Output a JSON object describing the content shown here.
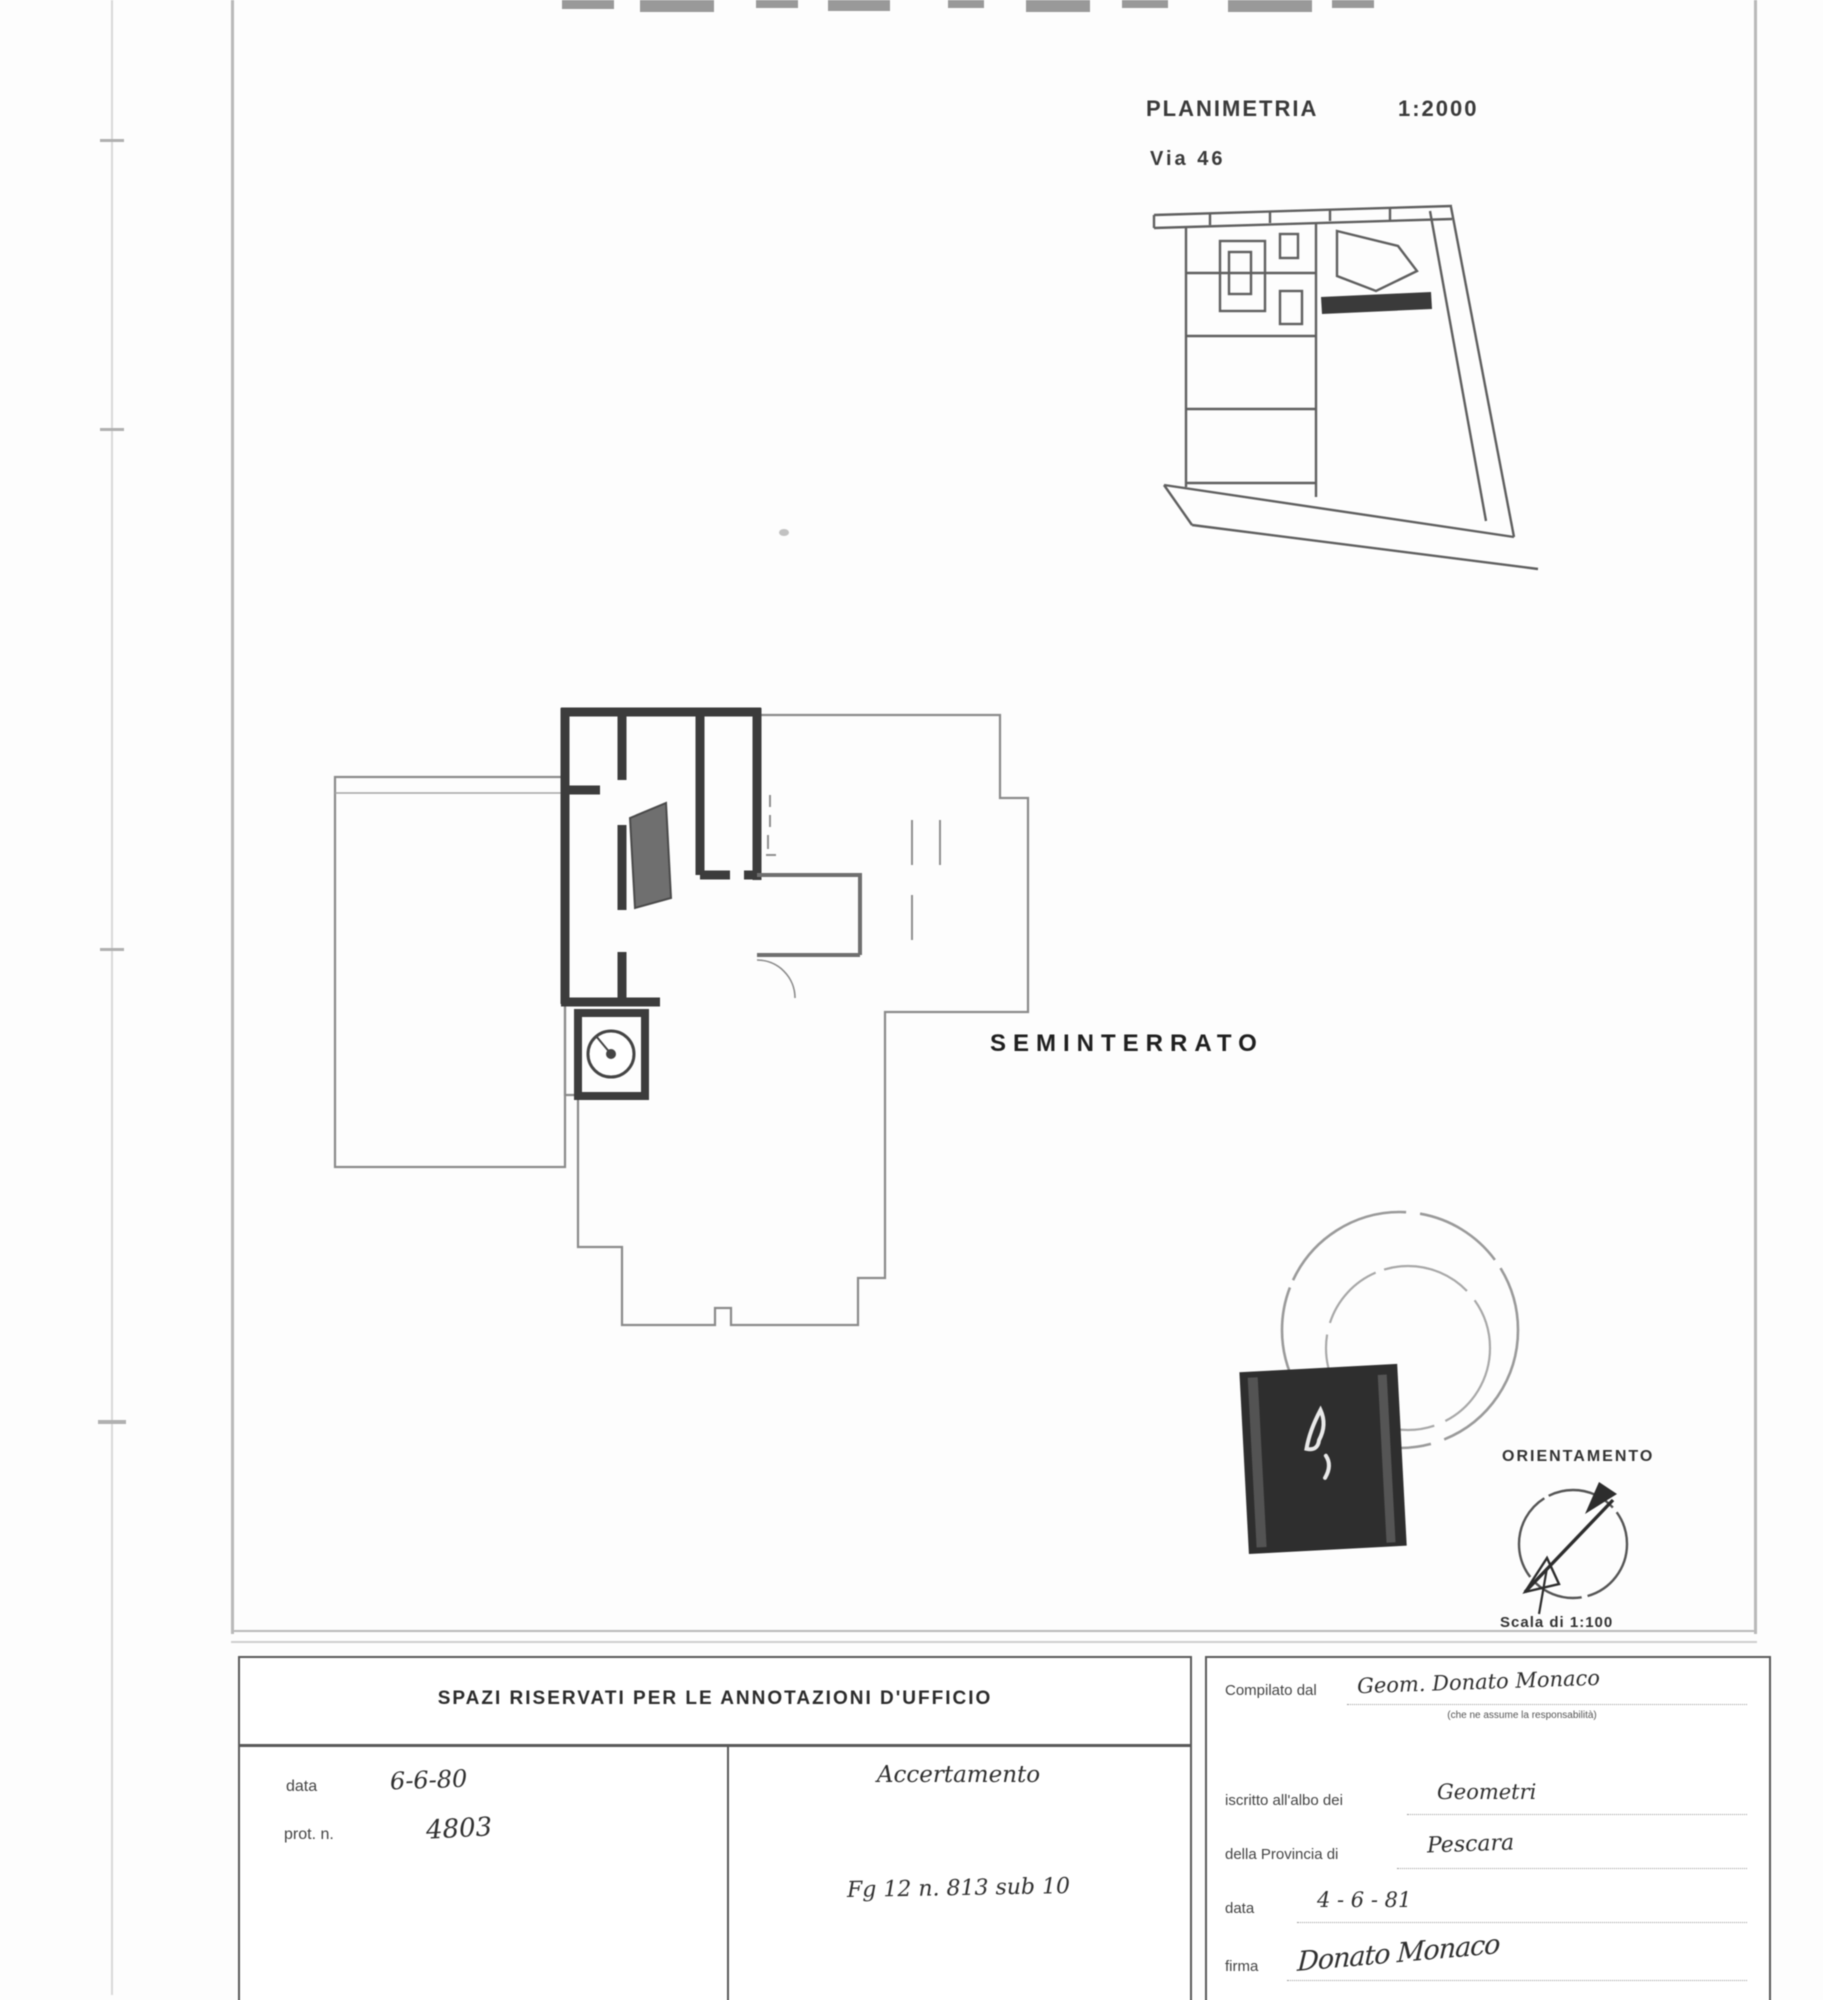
{
  "colors": {
    "ink": "#2e2e2e",
    "wall": "#3c3c3c",
    "stamp_block": "#2e2e2e"
  },
  "titles": {
    "plan_title": "PLANIMETRIA",
    "plan_scale": "1:2000",
    "street": "Via  46",
    "floor_label": "SEMINTERRATO",
    "orientation_label": "ORIENTAMENTO",
    "orientation_scale": "Scala di 1:100"
  },
  "form": {
    "office_header": "SPAZI RISERVATI PER LE ANNOTAZIONI D'UFFICIO",
    "left_cell": {
      "date_label": "data",
      "date_value": "6-6-80",
      "prot_label": "prot. n.",
      "prot_value": "4803"
    },
    "middle_cell": {
      "title": "Accertamento",
      "reference": "Fg 12 n. 813 sub 10"
    },
    "right_cell": {
      "compiled_by_label": "Compilato dal",
      "compiled_by_value": "Geom. Donato Monaco",
      "compiled_by_note": "(che ne assume la responsabilità)",
      "registered_label": "iscritto all'albo dei",
      "registered_value": "Geometri",
      "province_label": "della Provincia di",
      "province_value": "Pescara",
      "date_label": "data",
      "date_value": "4 - 6 - 81",
      "signature_label": "firma",
      "signature_value": "Donato Monaco"
    }
  }
}
